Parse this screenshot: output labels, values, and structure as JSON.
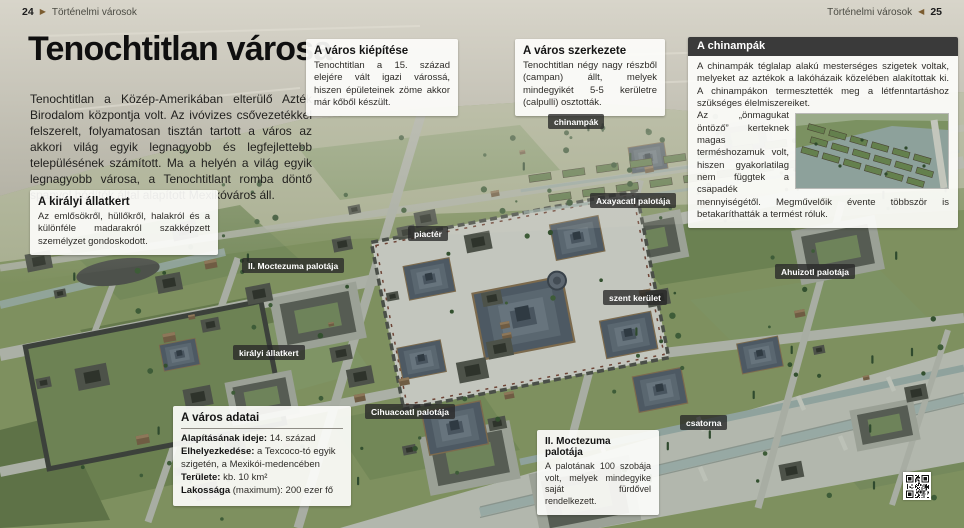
{
  "header": {
    "left": {
      "page": "24",
      "section": "Történelmi városok"
    },
    "right": {
      "page": "25",
      "section": "Történelmi városok"
    }
  },
  "icons": {
    "arrow_right": "▶",
    "arrow_left": "◀"
  },
  "article": {
    "title": "Tenochtitlan városa",
    "intro": "Tenochtitlan a Közép-Amerikában elterülő Azték Birodalom központja volt. Az ivóvizes csővezetékkel felszerelt, folyamatosan tisztán tartott a város az akkori világ egyik legnagyobb és legfejlettebb településének számított. Ma a helyén a világ egyik legnagyobb városa, a Tenochtitlant romba döntő spanyol hódítók által alapított Mexikóváros áll."
  },
  "boxes": {
    "kiepitese": {
      "title": "A város kiépítése",
      "body": "Tenochtitlan a 15. század elejére vált igazi várossá, hiszen épületeinek zöme akkor már kőből készült."
    },
    "szerkezete": {
      "title": "A város szerkezete",
      "body": "Tenochtitlan négy nagy részből (campan) állt, melyek mindegyikét 5-5 kerületre (calpulli) osztották."
    },
    "chinampak": {
      "title": "A chinampák",
      "body1": "A chinampák téglalap alakú mesterséges szigetek voltak, melyeket az aztékok a lakóházaik közelében alakítottak ki. A chinampákon termesztették meg a létfenntartáshoz szükséges élelmiszereiket.",
      "body2": "Az „önmagukat öntöző” kerteknek magas terméshozamuk volt, hiszen gyakorlatilag nem függtek a csapadék mennyiségétől. Megművelőik évente többször is betakaríthatták a termést róluk."
    },
    "allatkert": {
      "title": "A királyi állatkert",
      "body": "Az emlősökről, hüllőkről, halakról és a különféle madarakról szakképzett személyzet gondoskodott."
    },
    "adatai": {
      "title": "A város adatai",
      "rows": [
        {
          "label": "Alapításának ideje:",
          "value": "14. század"
        },
        {
          "label": "Elhelyezkedése:",
          "value": "a Texcoco-tó egyik szigetén, a Mexikói-medencében"
        },
        {
          "label": "Területe:",
          "value": "kb. 10 km²"
        },
        {
          "label": "Lakossága",
          "value": "(maximum): 200 ezer fő"
        }
      ]
    },
    "moctezuma": {
      "title": "II. Moctezuma palotája",
      "body": "A palotának 100 szobája volt, melyek mindegyike saját fürdővel rendelkezett."
    }
  },
  "map_labels": [
    {
      "id": "chinampak",
      "text": "chinampák"
    },
    {
      "id": "axayacatl",
      "text": "Axayacatl palotája"
    },
    {
      "id": "piacter",
      "text": "piactér"
    },
    {
      "id": "moctezuma-2",
      "text": "II. Moctezuma palotája"
    },
    {
      "id": "ahuizotl",
      "text": "Ahuizotl palotája"
    },
    {
      "id": "szent-kerulet",
      "text": "szent kerület"
    },
    {
      "id": "kiralyi-allatkert",
      "text": "királyi állatkert"
    },
    {
      "id": "cihuacoatl",
      "text": "Cihuacoatl palotája"
    },
    {
      "id": "csatorna",
      "text": "csatorna"
    }
  ],
  "colors": {
    "infobox_header_bg": "#3a3a3a",
    "map_label_bg": "#282828",
    "arrow_brown": "#7b5c30",
    "city_green": "#7e905f",
    "lake_haze": "#c9c6bb"
  }
}
